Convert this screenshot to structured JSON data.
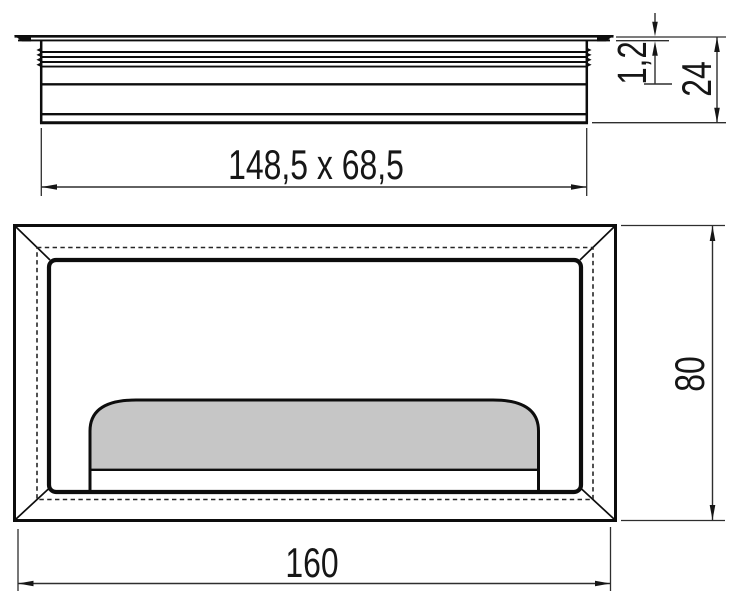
{
  "colors": {
    "background": "#ffffff",
    "object_line": "#0d0d0d",
    "dimension_line": "#2e2e2e",
    "hidden_line": "#262626",
    "lid_fill": "#c6c6c6"
  },
  "views": {
    "side_view": {
      "description_name": "side-profile-view"
    },
    "plan_view": {
      "description_name": "top-plan-view"
    }
  },
  "dimensions": {
    "cutout_label": "148,5 x 68,5",
    "flange_thickness_label": "1,2",
    "height_label": "24",
    "depth_label": "80",
    "width_label": "160"
  }
}
